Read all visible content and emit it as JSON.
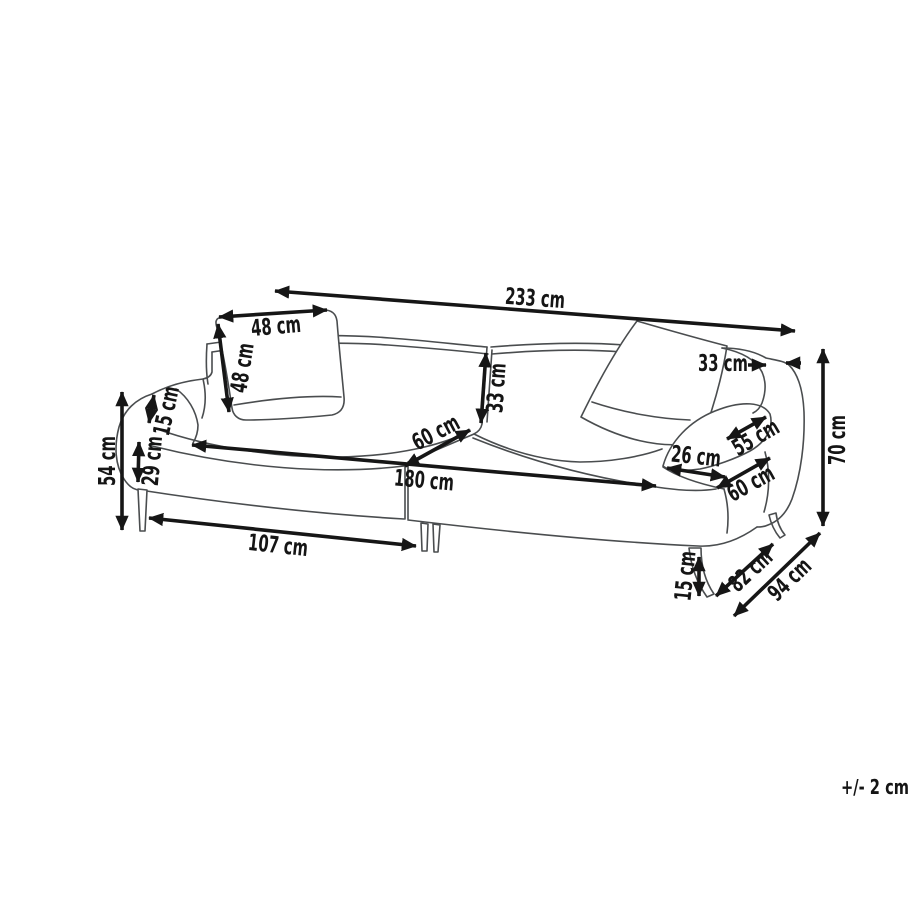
{
  "diagram": {
    "type": "furniture-dimension-diagram",
    "subject": "3-seater sofa line drawing with dimension arrows",
    "unit": "cm",
    "tolerance_note": "+/- 2 cm",
    "dimensions": [
      {
        "id": "overall-width",
        "label": "233 cm",
        "value": 233,
        "lx": 535,
        "ly": 299,
        "rot": 4.2,
        "lines": [
          {
            "x1": 275,
            "y1": 291,
            "x2": 795,
            "y2": 331,
            "heads": "both"
          }
        ]
      },
      {
        "id": "cushion-width",
        "label": "48 cm",
        "value": 48,
        "lx": 276,
        "ly": 327,
        "rot": -5,
        "lines": [
          {
            "x1": 219,
            "y1": 317,
            "x2": 327,
            "y2": 310,
            "heads": "both"
          }
        ]
      },
      {
        "id": "cushion-height",
        "label": "48 cm",
        "value": 48,
        "lx": 243,
        "ly": 368,
        "rot": -81,
        "lines": [
          {
            "x1": 218,
            "y1": 324,
            "x2": 229,
            "y2": 412,
            "heads": "both"
          }
        ]
      },
      {
        "id": "armrest-rise",
        "label": "15 cm",
        "value": 15,
        "lx": 167,
        "ly": 411,
        "rot": -78,
        "lines": [
          {
            "x1": 154,
            "y1": 395,
            "x2": 149,
            "y2": 423,
            "heads": "both"
          }
        ]
      },
      {
        "id": "base-front-height",
        "label": "29 cm",
        "value": 29,
        "lx": 153,
        "ly": 461,
        "rot": -85,
        "lines": [
          {
            "x1": 139,
            "y1": 442,
            "x2": 138,
            "y2": 482,
            "heads": "both"
          }
        ]
      },
      {
        "id": "arm-height",
        "label": "54 cm",
        "value": 54,
        "lx": 108,
        "ly": 461,
        "rot": -90,
        "lines": [
          {
            "x1": 122,
            "y1": 392,
            "x2": 122,
            "y2": 530,
            "heads": "both"
          }
        ]
      },
      {
        "id": "front-leg-spacing",
        "label": "107 cm",
        "value": 107,
        "lx": 278,
        "ly": 546,
        "rot": 6,
        "lines": [
          {
            "x1": 149,
            "y1": 518,
            "x2": 416,
            "y2": 546,
            "heads": "both"
          }
        ]
      },
      {
        "id": "seat-width",
        "label": "180 cm",
        "value": 180,
        "lx": 424,
        "ly": 481,
        "rot": 5,
        "lines": [
          {
            "x1": 192,
            "y1": 445,
            "x2": 656,
            "y2": 486,
            "heads": "both"
          }
        ]
      },
      {
        "id": "seat-depth",
        "label": "60 cm",
        "value": 60,
        "lx": 436,
        "ly": 433,
        "rot": -28,
        "lines": [
          {
            "x1": 405,
            "y1": 466,
            "x2": 470,
            "y2": 430,
            "heads": "both"
          }
        ]
      },
      {
        "id": "backrest-height",
        "label": "33 cm",
        "value": 33,
        "lx": 497,
        "ly": 388,
        "rot": -86,
        "lines": [
          {
            "x1": 486,
            "y1": 353,
            "x2": 481,
            "y2": 423,
            "heads": "both"
          }
        ]
      },
      {
        "id": "arm-top-width",
        "label": "33 cm",
        "value": 33,
        "lx": 723,
        "ly": 364,
        "rot": 0,
        "lines": [
          {
            "x1": 748,
            "y1": 365,
            "x2": 766,
            "y2": 365,
            "heads": "end"
          },
          {
            "x1": 801,
            "y1": 363,
            "x2": 786,
            "y2": 363,
            "heads": "end"
          }
        ]
      },
      {
        "id": "armrest-length",
        "label": "55 cm",
        "value": 55,
        "lx": 756,
        "ly": 438,
        "rot": -30,
        "lines": [
          {
            "x1": 727,
            "y1": 439,
            "x2": 766,
            "y2": 417,
            "heads": "both"
          }
        ]
      },
      {
        "id": "arm-front-width",
        "label": "26 cm",
        "value": 26,
        "lx": 696,
        "ly": 457,
        "rot": 6,
        "lines": [
          {
            "x1": 667,
            "y1": 468,
            "x2": 725,
            "y2": 477,
            "heads": "both"
          }
        ]
      },
      {
        "id": "arm-depth",
        "label": "60 cm",
        "value": 60,
        "lx": 751,
        "ly": 484,
        "rot": -29,
        "lines": [
          {
            "x1": 717,
            "y1": 488,
            "x2": 770,
            "y2": 458,
            "heads": "both"
          }
        ]
      },
      {
        "id": "overall-height",
        "label": "70 cm",
        "value": 70,
        "lx": 838,
        "ly": 440,
        "rot": -90,
        "lines": [
          {
            "x1": 823,
            "y1": 349,
            "x2": 823,
            "y2": 526,
            "heads": "both"
          }
        ]
      },
      {
        "id": "leg-height",
        "label": "15 cm",
        "value": 15,
        "lx": 686,
        "ly": 576,
        "rot": -84,
        "lines": [
          {
            "x1": 699,
            "y1": 557,
            "x2": 699,
            "y2": 596,
            "heads": "both"
          }
        ]
      },
      {
        "id": "seat-depth-floor",
        "label": "82 cm",
        "value": 82,
        "lx": 751,
        "ly": 571,
        "rot": -43,
        "lines": [
          {
            "x1": 716,
            "y1": 596,
            "x2": 773,
            "y2": 544,
            "heads": "both"
          }
        ]
      },
      {
        "id": "overall-depth",
        "label": "94 cm",
        "value": 94,
        "lx": 790,
        "ly": 580,
        "rot": -44,
        "lines": [
          {
            "x1": 734,
            "y1": 616,
            "x2": 820,
            "y2": 533,
            "heads": "both"
          }
        ]
      }
    ]
  }
}
